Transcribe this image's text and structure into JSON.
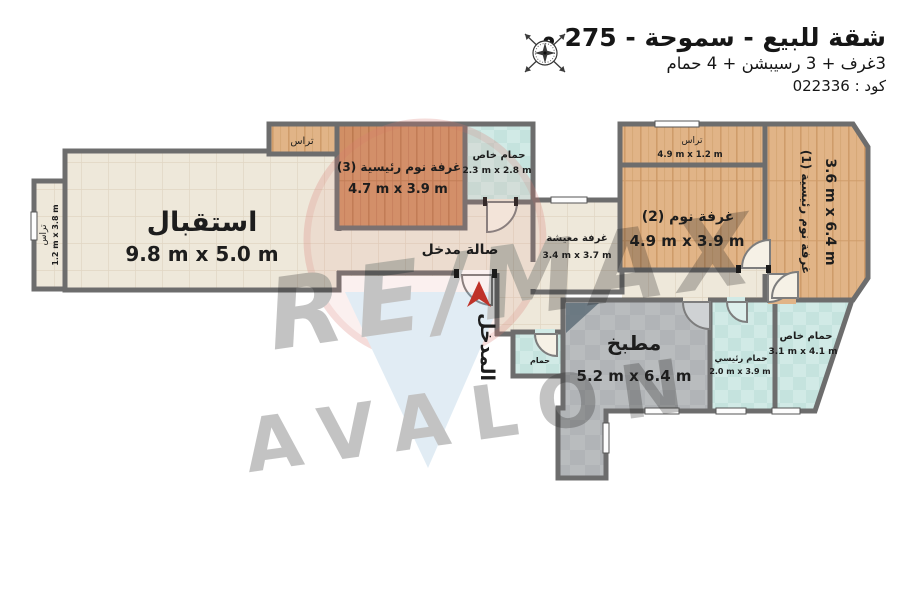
{
  "header": {
    "title": "شقة للبيع - سموحة - 275 م",
    "subtitle": "3غرف + 3 رسيبشن + 4 حمام",
    "code": "كود : 022336"
  },
  "compass": {
    "icon": "compass-rose-icon"
  },
  "entrance": {
    "label": "المدخل",
    "arrow_color": "#bf3229"
  },
  "watermark": {
    "brand": "RE/MAX",
    "name": "AVALON",
    "red": "#cc4b41",
    "blue": "#8db9d8"
  },
  "rooms": {
    "reception": {
      "name": "استقبال",
      "dims": "9.8 m x 5.0 m"
    },
    "terrace_left": {
      "name": "تراس",
      "dims": "1.2 m x 3.8 m"
    },
    "terrace_top": {
      "name": "تراس"
    },
    "bedroom3": {
      "name": "غرفة نوم رئيسية (3)",
      "dims": "4.7 m x 3.9 m"
    },
    "bath3": {
      "name": "حمام خاص",
      "dims": "2.3 m x 2.8 m"
    },
    "hall": {
      "name": "صالة مدخل"
    },
    "living": {
      "name": "غرفة معيشة",
      "dims": "3.4 m x 3.7 m"
    },
    "terrace_right": {
      "name": "تراس",
      "dims": "4.9 m x 1.2 m"
    },
    "bedroom2": {
      "name": "غرفة نوم (2)",
      "dims": "4.9 m x 3.9 m"
    },
    "bedroom1": {
      "name": "غرفة نوم رئيسية (1)",
      "dims": "3.6 m x 6.4 m"
    },
    "kitchen": {
      "name": "مطبخ",
      "dims": "5.2 m x 6.4 m"
    },
    "bath_master": {
      "name": "حمام رئيسي",
      "dims": "2.0 m x 3.9 m"
    },
    "bath_private": {
      "name": "حمام خاص",
      "dims": "3.1 m x 4.1 m"
    },
    "bath_small": {
      "name": "حمام"
    }
  },
  "colors": {
    "wall": "#6d6d6d",
    "floor_tile": "#eee8da",
    "floor_wood_dark": "#d18f65",
    "floor_wood_light": "#e1b487",
    "floor_bath": "#d1eae6",
    "floor_kitchen": "#b9bcbe"
  }
}
